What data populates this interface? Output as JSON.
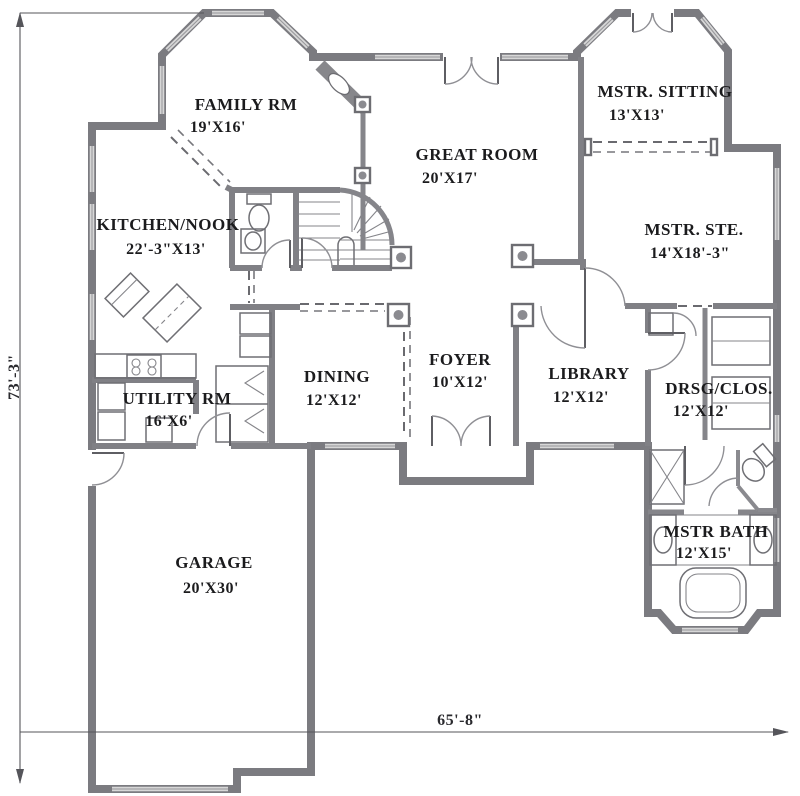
{
  "rooms": {
    "family_room": {
      "name": "FAMILY RM",
      "dims": "19'X16'"
    },
    "great_room": {
      "name": "GREAT ROOM",
      "dims": "20'X17'"
    },
    "master_sitting": {
      "name": "MSTR. SITTING",
      "dims": "13'X13'"
    },
    "master_suite": {
      "name": "MSTR. STE.",
      "dims": "14'X18'-3\""
    },
    "kitchen_nook": {
      "name": "KITCHEN/NOOK",
      "dims": "22'-3\"X13'"
    },
    "dining": {
      "name": "DINING",
      "dims": "12'X12'"
    },
    "foyer": {
      "name": "FOYER",
      "dims": "10'X12'"
    },
    "library": {
      "name": "LIBRARY",
      "dims": "12'X12'"
    },
    "dressing_closet": {
      "name": "DRSG/CLOS.",
      "dims": "12'X12'"
    },
    "utility": {
      "name": "UTILITY RM",
      "dims": "16'X6'"
    },
    "garage": {
      "name": "GARAGE",
      "dims": "20'X30'"
    },
    "master_bath": {
      "name": "MSTR BATH",
      "dims": "12'X15'"
    }
  },
  "dimensions": {
    "overall_depth": "73'-3\"",
    "overall_width": "65'-8\""
  },
  "colors": {
    "wall": "#7b7b80",
    "window": "#d7d7d7",
    "thin_line": "#6f6f74",
    "text": "#1b1b1d",
    "background": "#ffffff"
  },
  "fixture_icons": [
    "curved-staircase-icon",
    "corner-fireplace-icon",
    "kitchen-island-icon",
    "range-icon",
    "washer-dryer-icon",
    "water-heater-icon",
    "pantry-cabinet-icon",
    "bifold-closet-icon",
    "powder-toilet-icon",
    "pedestal-sink-icon",
    "walk-in-shower-icon",
    "toilet-compartment-icon",
    "vanity-sink-icon",
    "garden-tub-icon",
    "closet-shelving-icon",
    "double-entry-door-icon"
  ]
}
